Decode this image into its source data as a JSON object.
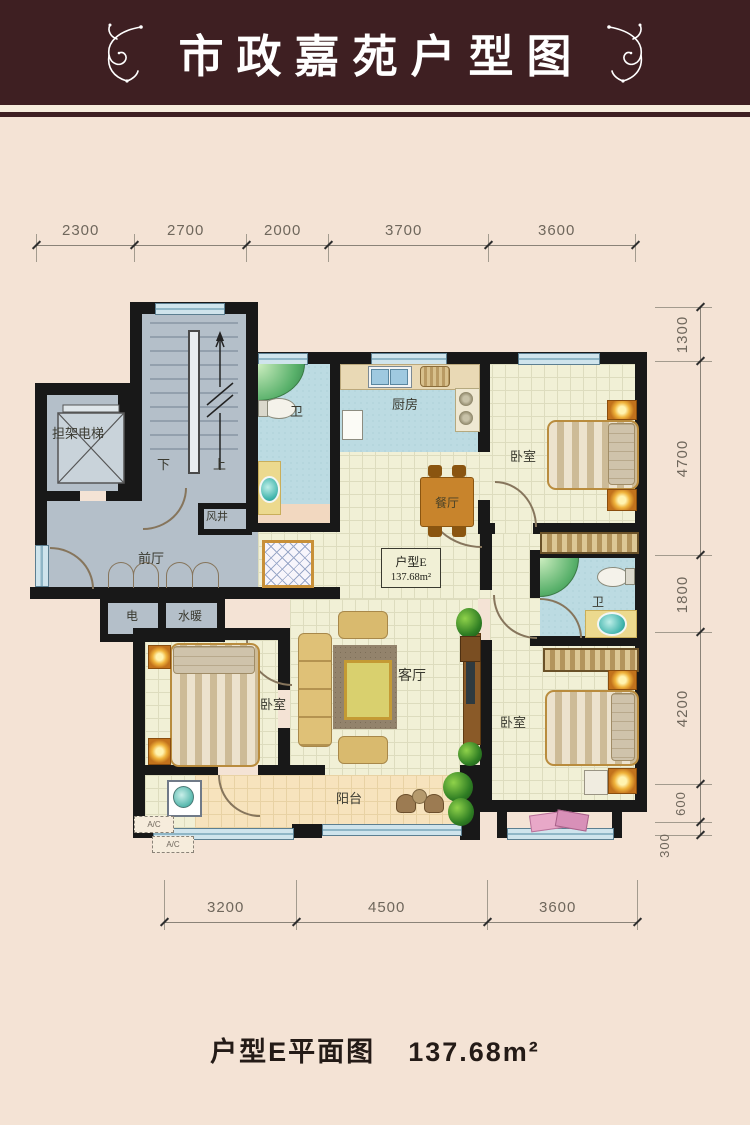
{
  "header": {
    "title": "市政嘉苑户型图"
  },
  "unit_label": {
    "name": "户型E",
    "area": "137.68m²"
  },
  "caption": {
    "title": "户型E平面图",
    "area": "137.68m²"
  },
  "dimensions": {
    "top": [
      "2300",
      "2700",
      "2000",
      "3700",
      "3600"
    ],
    "right": [
      "1300",
      "4700",
      "1800",
      "4200",
      "600",
      "300"
    ],
    "bottom": [
      "3200",
      "4500",
      "3600"
    ]
  },
  "rooms": {
    "elevator": "担架电梯",
    "stairs_down": "下",
    "stairs_up": "上",
    "air_shaft": "风井",
    "front_hall": "前厅",
    "electric": "电",
    "plumbing": "水暖",
    "bath_top": "卫",
    "bath_mid": "卫",
    "kitchen": "厨房",
    "dining": "餐厅",
    "bedroom_top_right": "卧室",
    "bedroom_bottom_left": "卧室",
    "bedroom_bottom_right": "卧室",
    "living": "客厅",
    "balcony": "阳台",
    "ac_unit_1": "A/C",
    "ac_unit_2": "A/C"
  },
  "colors": {
    "header_bg": "#3e1f22",
    "page_bg": "#f4e3d5",
    "wall": "#181818",
    "floor_tile": "#f1f0d6",
    "floor_public": "#b4bfc9",
    "floor_wet": "#bcdbe2",
    "floor_balcony": "#f7e3bd",
    "window": "#cfe4ec",
    "wood": "#c8842c"
  }
}
